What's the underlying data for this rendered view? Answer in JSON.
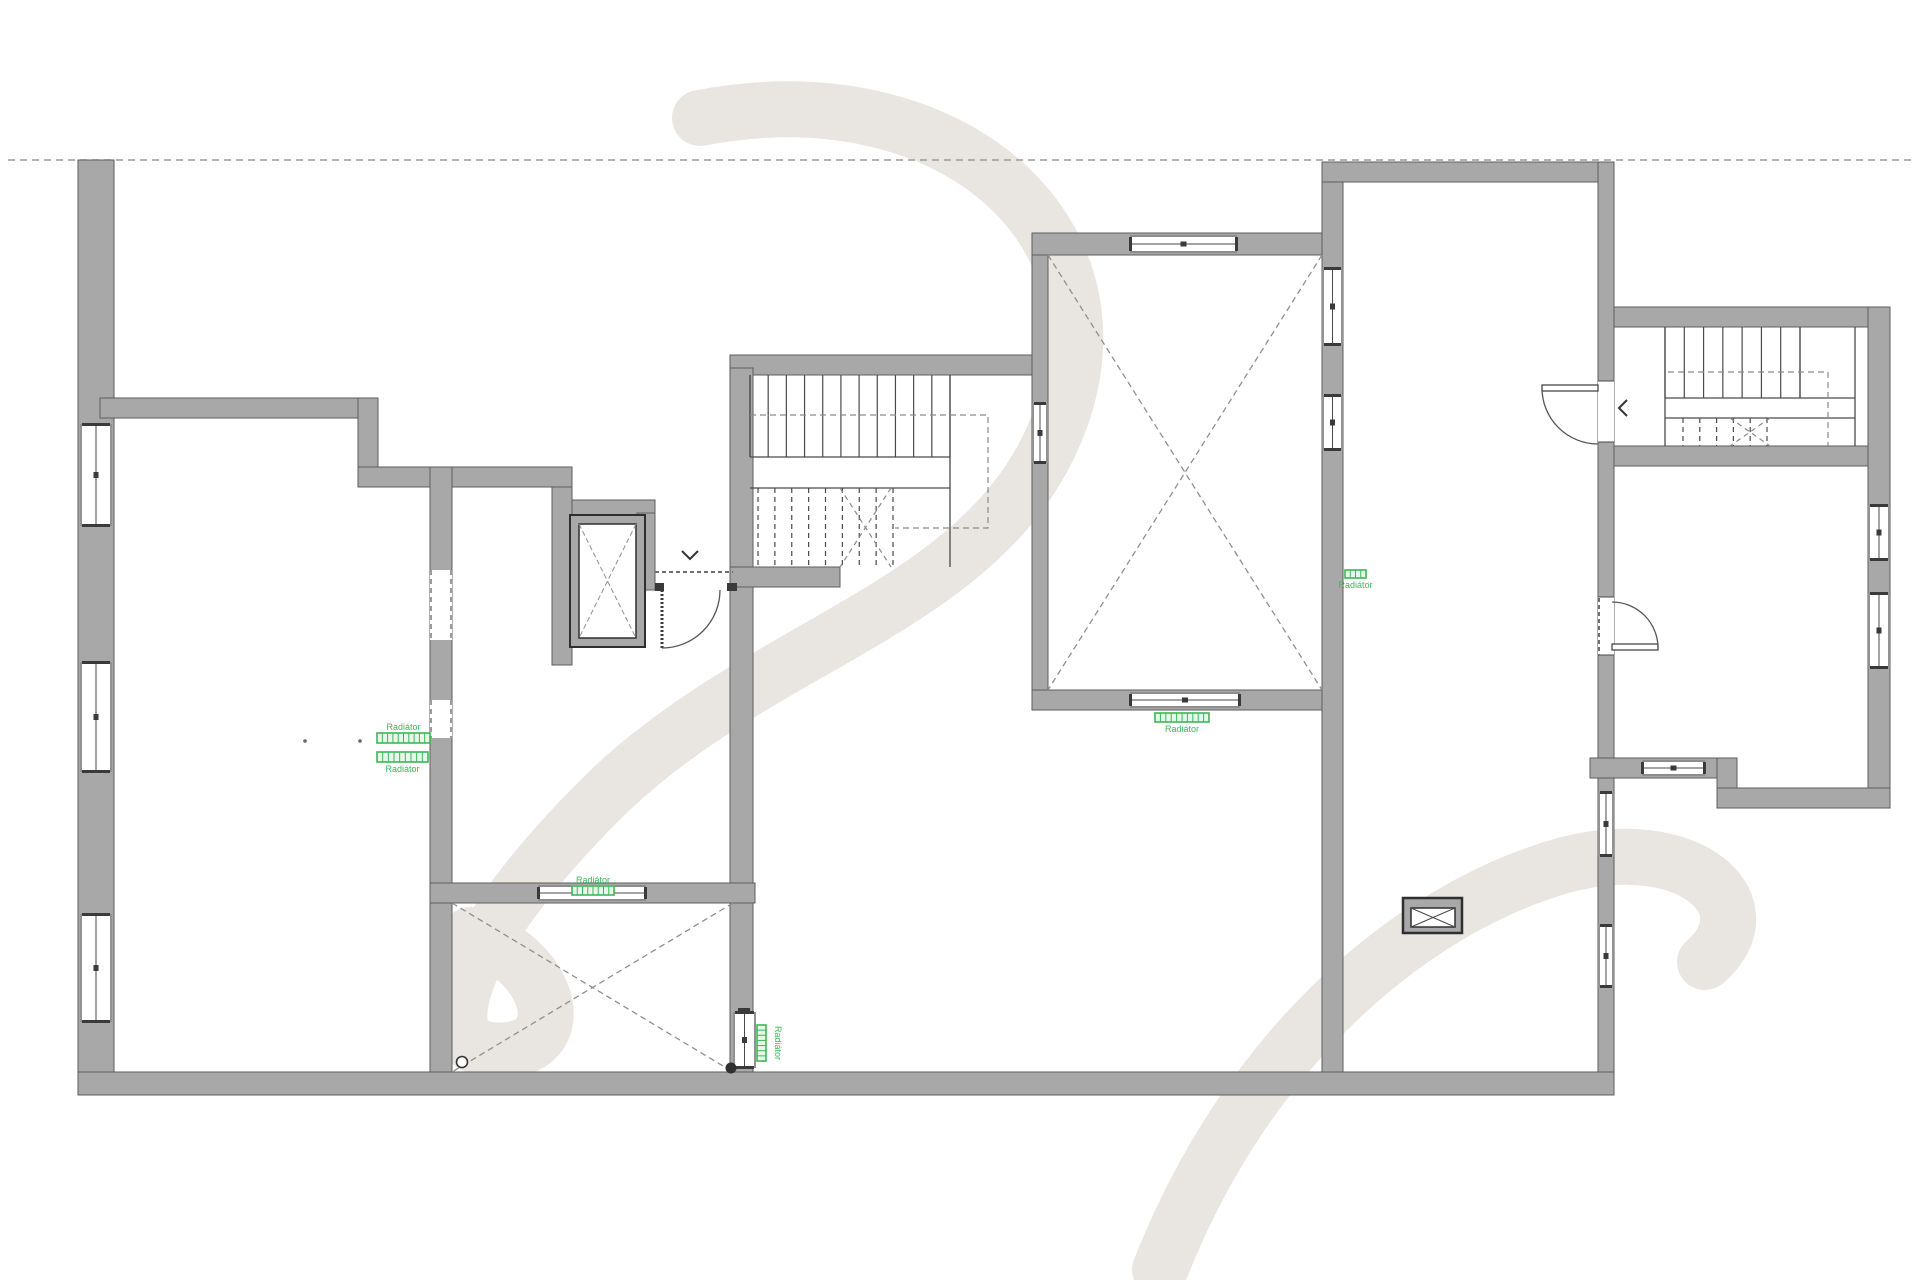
{
  "plan": {
    "canvas": {
      "w": 1920,
      "h": 1280
    },
    "colors": {
      "bg": "#ffffff",
      "wall_fill": "#a8a8a8",
      "wall_edge": "#5e5e5e",
      "line_dark": "#3a3a3a",
      "thin_line": "#4a4a4a",
      "dash_line": "#999999",
      "boundary_dash": "#9a9a9a",
      "green": "#3cb857",
      "green_fill": "#e6f8ea",
      "watermark": "#e9e6e1"
    },
    "boundary_line": {
      "x1": 8,
      "y1": 160,
      "x2": 1912,
      "y2": 160
    },
    "walls": [
      [
        78,
        160,
        36,
        935
      ],
      [
        78,
        1072,
        1536,
        23
      ],
      [
        100,
        398,
        278,
        20
      ],
      [
        358,
        398,
        20,
        89
      ],
      [
        358,
        467,
        214,
        20
      ],
      [
        552,
        487,
        20,
        178
      ],
      [
        572,
        500,
        83,
        17
      ],
      [
        637,
        513,
        18,
        77
      ],
      [
        730,
        355,
        302,
        20
      ],
      [
        730,
        368,
        23,
        704
      ],
      [
        730,
        567,
        110,
        20
      ],
      [
        430,
        467,
        22,
        605
      ],
      [
        430,
        883,
        325,
        20
      ],
      [
        1032,
        233,
        16,
        477
      ],
      [
        1032,
        233,
        310,
        22
      ],
      [
        1032,
        690,
        310,
        20
      ],
      [
        1322,
        162,
        21,
        910
      ],
      [
        1322,
        162,
        292,
        20
      ],
      [
        1598,
        162,
        16,
        910
      ],
      [
        1614,
        307,
        276,
        20
      ],
      [
        1868,
        307,
        22,
        500
      ],
      [
        1614,
        446,
        254,
        20
      ],
      [
        1590,
        758,
        147,
        20
      ],
      [
        1717,
        758,
        20,
        50
      ],
      [
        1717,
        788,
        173,
        20
      ]
    ],
    "jambs": [
      [
        655,
        583,
        9,
        8
      ],
      [
        727,
        583,
        10,
        8
      ],
      [
        738,
        1008,
        12,
        8
      ]
    ],
    "openings": [
      {
        "t": "window-v",
        "x": 80,
        "y": 424,
        "w": 32,
        "h": 102
      },
      {
        "t": "window-v",
        "x": 80,
        "y": 662,
        "w": 32,
        "h": 110
      },
      {
        "t": "window-v",
        "x": 80,
        "y": 914,
        "w": 32,
        "h": 108
      },
      {
        "t": "window-v",
        "x": 1598,
        "y": 792,
        "w": 16,
        "h": 64
      },
      {
        "t": "window-v",
        "x": 1598,
        "y": 925,
        "w": 16,
        "h": 62
      },
      {
        "t": "window-v",
        "x": 1868,
        "y": 505,
        "w": 22,
        "h": 55
      },
      {
        "t": "window-v",
        "x": 1868,
        "y": 593,
        "w": 22,
        "h": 75
      },
      {
        "t": "window-h",
        "x": 1642,
        "y": 760,
        "w": 63,
        "h": 16
      },
      {
        "t": "glazed-h",
        "x": 538,
        "y": 885,
        "w": 108,
        "h": 16
      },
      {
        "t": "glazed-h",
        "x": 1130,
        "y": 235,
        "w": 107,
        "h": 18
      },
      {
        "t": "glazed-h",
        "x": 1130,
        "y": 692,
        "w": 110,
        "h": 16
      },
      {
        "t": "glazed-v",
        "x": 1032,
        "y": 403,
        "w": 16,
        "h": 60
      },
      {
        "t": "glazed-v",
        "x": 1322,
        "y": 268,
        "w": 21,
        "h": 77
      },
      {
        "t": "glazed-v",
        "x": 1322,
        "y": 395,
        "w": 21,
        "h": 55
      },
      {
        "t": "glazed-v",
        "x": 733,
        "y": 1012,
        "w": 23,
        "h": 56
      },
      {
        "t": "door-v",
        "x": 1598,
        "y": 381,
        "w": 16,
        "h": 61
      },
      {
        "t": "door-v",
        "x": 1598,
        "y": 597,
        "w": 16,
        "h": 58
      },
      {
        "t": "dash-v",
        "x": 430,
        "y": 570,
        "w": 22,
        "h": 70
      },
      {
        "t": "dash-v",
        "x": 430,
        "y": 700,
        "w": 22,
        "h": 38
      }
    ],
    "dashed_lines": [
      [
        655,
        572,
        733,
        572
      ],
      [
        1599,
        598,
        1599,
        655
      ]
    ],
    "elevator": {
      "outer": [
        570,
        515,
        75,
        132
      ],
      "inner": [
        579,
        524,
        57,
        114
      ]
    },
    "xrooms": [
      {
        "x": 452,
        "y": 903,
        "w": 281,
        "h": 169
      },
      {
        "x": 1048,
        "y": 255,
        "w": 274,
        "h": 435
      }
    ],
    "stairs": [
      {
        "name": "central-staircase",
        "top_flight": {
          "x1": 750,
          "x2": 950,
          "y1": 375,
          "y2": 457,
          "n": 12,
          "dashed": false
        },
        "low_flight": {
          "x1": 758,
          "x2": 893,
          "y1": 488,
          "y2": 567,
          "n": 9,
          "dashed": true
        },
        "landing_lines": [
          [
            750,
            457,
            950,
            457
          ],
          [
            750,
            488,
            950,
            488
          ]
        ],
        "edges": [
          [
            950,
            375,
            950,
            567
          ],
          [
            750,
            375,
            750,
            457
          ]
        ],
        "diagonals": [
          [
            840,
            488,
            891,
            567
          ],
          [
            891,
            488,
            840,
            567
          ]
        ],
        "walkline": "M750,415 L988,415 L988,528 L895,528"
      },
      {
        "name": "right-staircase",
        "top_flight": {
          "x1": 1665,
          "x2": 1800,
          "y1": 327,
          "y2": 398,
          "n": 8,
          "dashed": false
        },
        "low_flight": {
          "x1": 1683,
          "x2": 1767,
          "y1": 418,
          "y2": 446,
          "n": 6,
          "dashed": true
        },
        "landing_lines": [
          [
            1665,
            398,
            1855,
            398
          ],
          [
            1665,
            418,
            1855,
            418
          ]
        ],
        "edges": [
          [
            1855,
            327,
            1855,
            446
          ],
          [
            1665,
            327,
            1665,
            446
          ],
          [
            1800,
            327,
            1800,
            398
          ]
        ],
        "diagonals": [
          [
            1730,
            418,
            1770,
            446
          ],
          [
            1770,
            418,
            1730,
            446
          ]
        ],
        "walkline": "M1668,372 L1828,372 L1828,446"
      }
    ],
    "doors": [
      {
        "name": "entry-door",
        "leaf": {
          "x1": 662,
          "y1": 590,
          "x2": 662,
          "y2": 648,
          "dotted": true
        },
        "arc": "M662,648 A58 58 0 0 0 720,590"
      },
      {
        "name": "tall-room-stair-door",
        "leaf_rect": [
          1542,
          385,
          56,
          6
        ],
        "arc": "M1542,388 A56 56 0 0 0 1598,444"
      },
      {
        "name": "lower-right-room-door",
        "leaf_rect": [
          1612,
          644,
          46,
          6
        ],
        "arc": "M1658,648 A46 46 0 0 0 1612,602"
      }
    ],
    "radiators": [
      {
        "x": 377,
        "y": 733,
        "w": 53,
        "h": 10,
        "orient": "h",
        "label": "Radiátor",
        "label_side": "top"
      },
      {
        "x": 377,
        "y": 752,
        "w": 51,
        "h": 10,
        "orient": "h",
        "label": "Radiátor",
        "label_side": "bottom"
      },
      {
        "x": 572,
        "y": 886,
        "w": 42,
        "h": 9,
        "orient": "h",
        "label": "Radiátor",
        "label_side": "top"
      },
      {
        "x": 1155,
        "y": 713,
        "w": 54,
        "h": 9,
        "orient": "h",
        "label": "Radiátor",
        "label_side": "bottom"
      },
      {
        "x": 1345,
        "y": 570,
        "w": 21,
        "h": 8,
        "orient": "h",
        "label": "Radiátor",
        "label_side": "bottom"
      },
      {
        "x": 757,
        "y": 1025,
        "w": 9,
        "h": 36,
        "orient": "v",
        "label": "Radiátor",
        "label_side": "right"
      }
    ],
    "symbols": {
      "chevron_down": {
        "points": "682,551 690,559 698,551"
      },
      "chevron_left": {
        "points": "1627,400 1619,408 1627,416"
      },
      "xbox": {
        "outer": [
          1403,
          898,
          59,
          35
        ],
        "inner": [
          1411,
          908,
          44,
          19
        ]
      },
      "circle_open": {
        "cx": 462,
        "cy": 1062,
        "r": 5.5
      },
      "circle_filled": {
        "cx": 731,
        "cy": 1068,
        "r": 5.5
      },
      "dots": [
        [
          305,
          741
        ],
        [
          360,
          741
        ]
      ]
    },
    "watermark_paths": [
      "M 700,118 C 950,70 1130,230 1060,420 C 990,610 760,640 600,800 C 450,950 420,1060 510,1050 C 575,1040 545,955 470,935",
      "M 1160,1270 C 1250,1040 1420,905 1565,865 C 1690,832 1770,905 1705,962"
    ]
  }
}
